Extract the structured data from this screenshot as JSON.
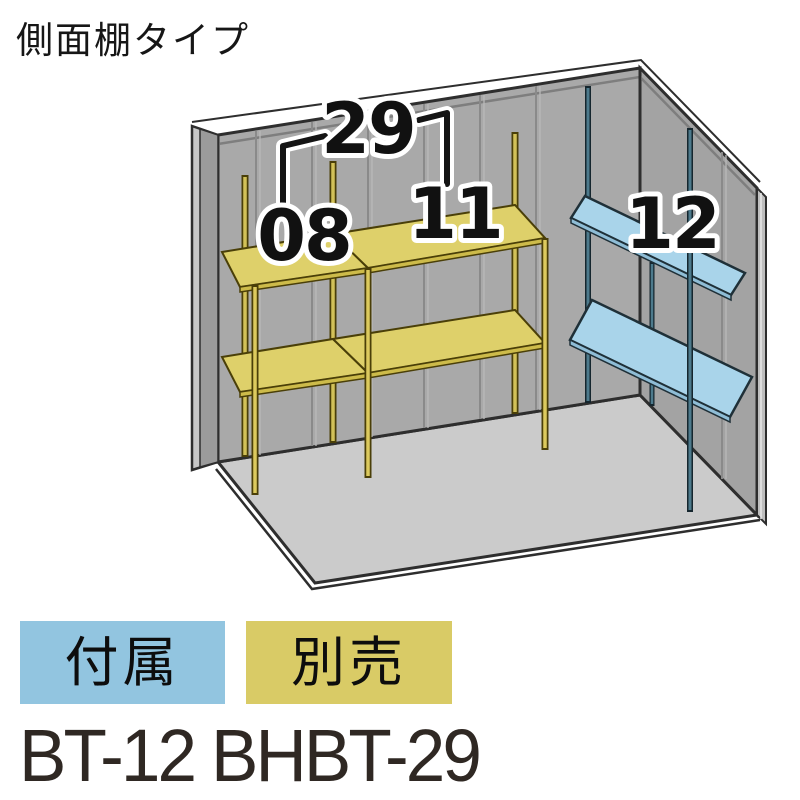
{
  "title": "側面棚タイプ",
  "labels": {
    "span": "29",
    "left_bay": "08",
    "right_bay": "11",
    "side_shelf": "12"
  },
  "legend": {
    "included": {
      "label": "付属",
      "color": "#92c5e0"
    },
    "optional": {
      "label": "別売",
      "color": "#d9cb66"
    }
  },
  "model_text": "BT-12 BHBT-29",
  "colors": {
    "optional_shelf": "#ded06a",
    "optional_shelf_edge": "#cdbb4a",
    "included_shelf": "#a9d4ea",
    "included_shelf_edge": "#8fbdd6",
    "wall": "#a9a9a9",
    "right_wall": "#a3a3a3",
    "floor": "#cbcbcb"
  }
}
